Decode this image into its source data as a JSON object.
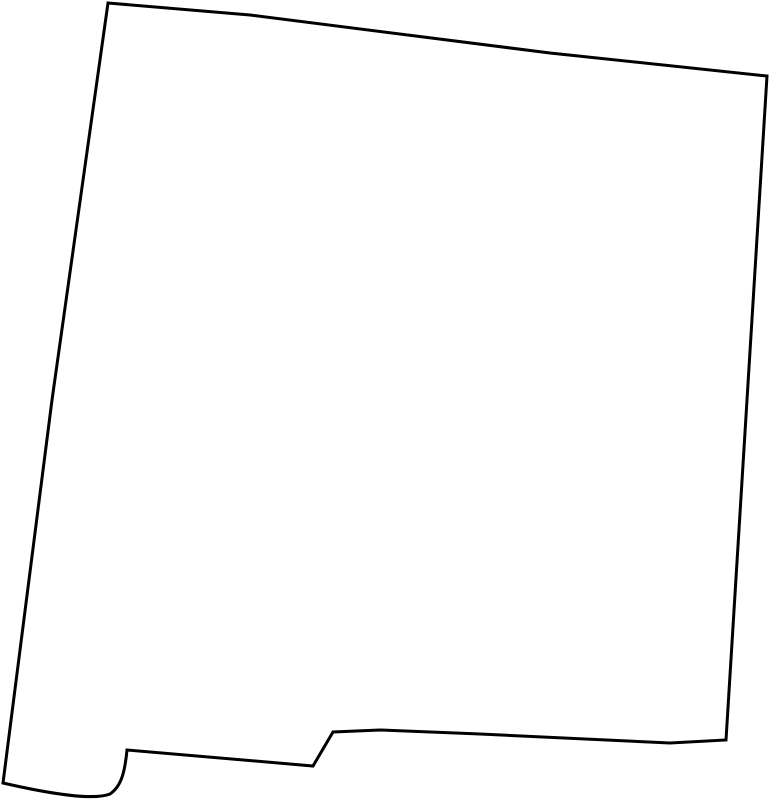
{
  "map": {
    "region": "New Mexico",
    "shape": "state-outline",
    "background_color": "#ffffff",
    "fill_color": "#ffffff",
    "stroke_color": "#000000",
    "stroke_width": "3",
    "viewbox": "0 0 769 800",
    "outline_path": "M 108 3 L 250 15 L 550 53 L 767 76 L 726 740 L 670 743 L 480 734 L 380 730 L 333 732 L 313 766 L 127 750 C 125 770 122 786 110 794 C 95 800 55 795 3 783 L 52 400 Z"
  }
}
